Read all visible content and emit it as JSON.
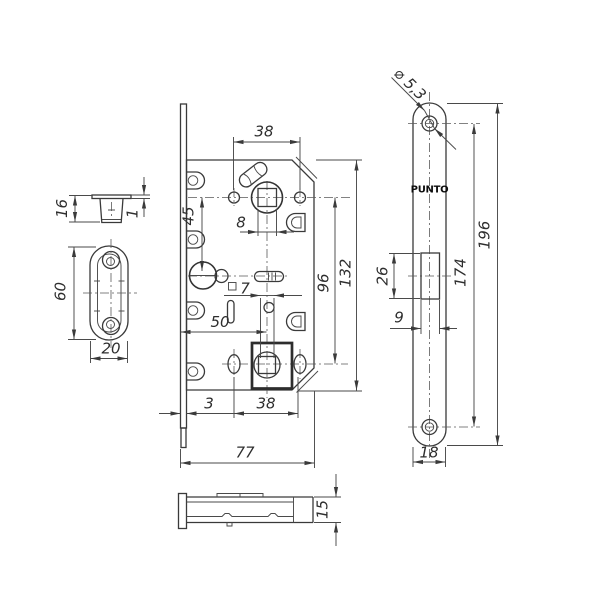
{
  "brand": "PUNTO",
  "colors": {
    "line": "#3a3a3a",
    "background": "#ffffff",
    "text": "#2e2e2e"
  },
  "center_view": {
    "dim_top_screw_spacing": "38",
    "dim_hub_to_wc": "45",
    "dim_square_top": "8",
    "dim_hub_centers": "96",
    "dim_body_height": "132",
    "dim_square_bottom": "7",
    "dim_backset": "50",
    "dim_faceplate_offset": "3",
    "dim_bottom_screw_spacing": "38",
    "dim_total_depth": "77"
  },
  "faceplate_view": {
    "dim_hole_dia": "⌀ 5,3",
    "brand_label": "PUNTO",
    "dim_total_length": "196",
    "dim_screw_spacing": "174",
    "dim_latch_cutout_height": "26",
    "dim_latch_cutout_width": "9",
    "dim_width": "18"
  },
  "strike_top_view": {
    "dim_depth": "16",
    "dim_flange_thickness": "1"
  },
  "strike_front_view": {
    "dim_length": "60",
    "dim_width": "20"
  },
  "side_view": {
    "dim_thickness": "15"
  }
}
